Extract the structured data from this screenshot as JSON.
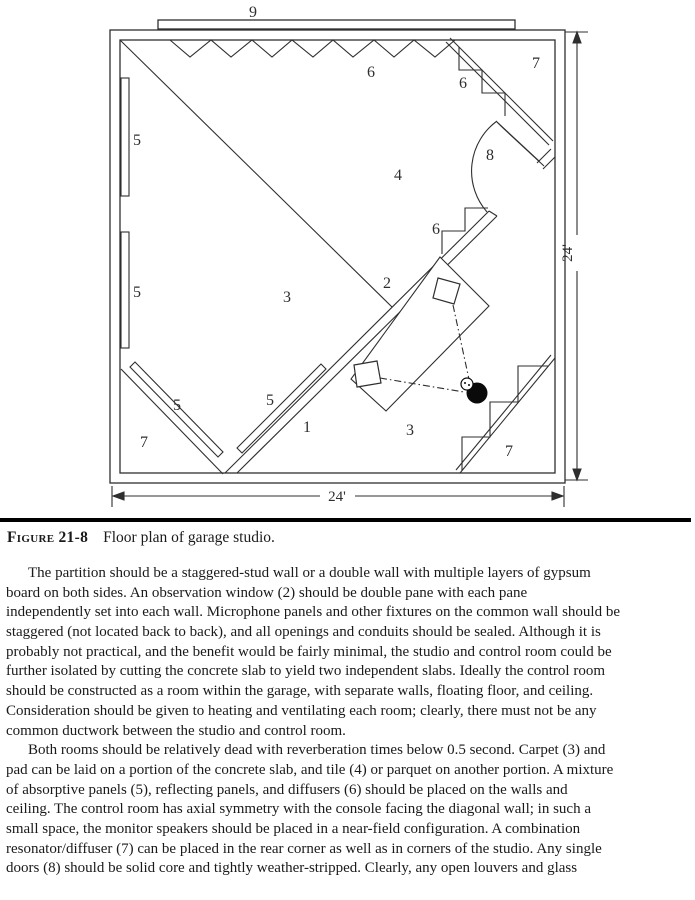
{
  "figure": {
    "labels": {
      "ridge": "9",
      "ceiling_diffusers": "6",
      "corner_diffuser_top": "6",
      "resonator_top_right": "7",
      "panel_left_upper": "5",
      "door": "8",
      "tile_area": "4",
      "wall_diffuser": "6",
      "observation_window": "2",
      "carpet_studio": "3",
      "panel_left_lower": "5",
      "panel_corner_left": "5",
      "panel_partition": "5",
      "resonator_bottom_left": "7",
      "partition_wall": "1",
      "carpet_control_room": "3",
      "resonator_bottom_right": "7"
    },
    "dimensions": {
      "width": "24'",
      "height": "24'"
    }
  },
  "caption": {
    "label": "Figure 21-8",
    "text": "Floor plan of garage studio."
  },
  "body": {
    "para1": [
      "The partition should be a staggered-stud wall or a double wall with multiple layers of gypsum",
      "board on both sides. An observation window (2) should be double pane with each pane",
      "independently set into each wall. Microphone panels and other fixtures on the common wall should be",
      "staggered (not located back to back), and all openings and conduits should be sealed. Although it is",
      "probably not practical, and the benefit would be fairly minimal, the studio and control room could be",
      "further isolated by cutting the concrete slab to yield two independent slabs. Ideally the control room",
      "should be constructed as a room within the garage, with separate walls, floating floor, and ceiling.",
      "Consideration should be given to heating and ventilating each room; clearly, there must not be any",
      "common ductwork between the studio and control room."
    ],
    "para2": [
      "Both rooms should be relatively dead with reverberation times below 0.5 second. Carpet (3) and",
      "pad can be laid on a portion of the concrete slab, and tile (4) or parquet on another portion. A mixture",
      "of absorptive panels (5), reflecting panels, and diffusers (6) should be placed on the walls and",
      "ceiling. The control room has axial symmetry with the console facing the diagonal wall; in such a",
      "small space, the monitor speakers should be placed in a near-field configuration. A combination",
      "resonator/diffuser (7) can be placed in the rear corner as well as in corners of the studio. Any single",
      "doors (8) should be solid core and tightly weather-stripped. Clearly, any open louvers and glass"
    ]
  }
}
